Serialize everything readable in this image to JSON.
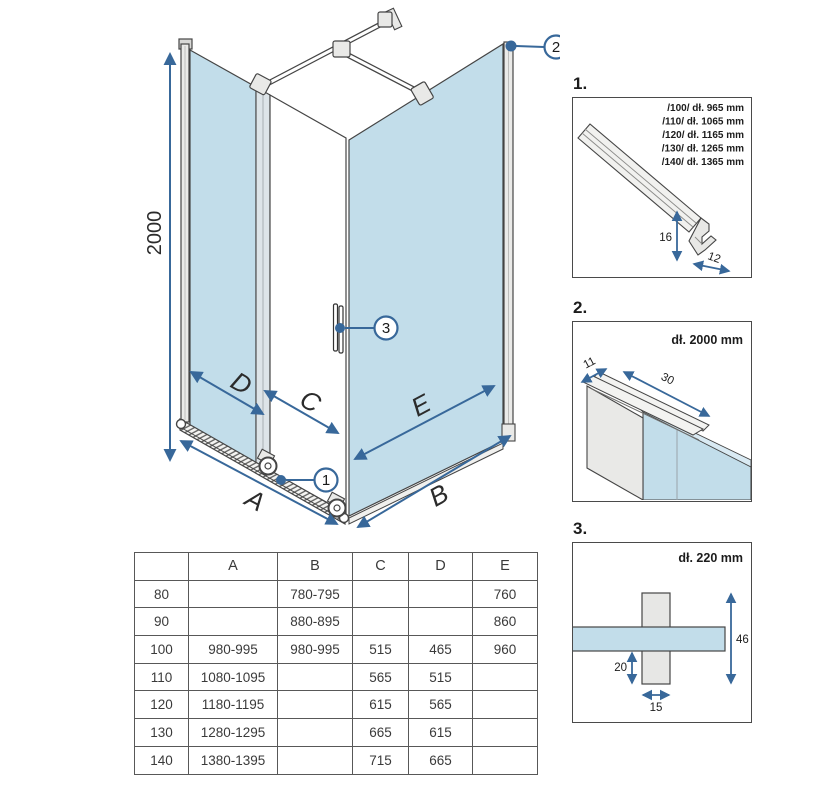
{
  "diagram": {
    "height_dim": "2000",
    "dim_a": "A",
    "dim_b": "B",
    "dim_c": "C",
    "dim_d": "D",
    "dim_e": "E",
    "callout_1": "1",
    "callout_2": "2",
    "callout_3": "3"
  },
  "details": {
    "d1": {
      "label": "1.",
      "size_lines": [
        "/100/ dł. 965 mm",
        "/110/ dł. 1065 mm",
        "/120/ dł. 1165 mm",
        "/130/ dł. 1265 mm",
        "/140/ dł. 1365 mm"
      ],
      "dim_height": "16",
      "dim_depth": "12"
    },
    "d2": {
      "label": "2.",
      "length": "dł. 2000 mm",
      "dim_width": "11",
      "dim_depth": "30"
    },
    "d3": {
      "label": "3.",
      "length": "dł. 220 mm",
      "dim_total_height": "46",
      "dim_lower_height": "20",
      "dim_width": "15"
    }
  },
  "table": {
    "headers": [
      "",
      "A",
      "B",
      "C",
      "D",
      "E"
    ],
    "rows": [
      [
        "80",
        "",
        "780-795",
        "",
        "",
        "760"
      ],
      [
        "90",
        "",
        "880-895",
        "",
        "",
        "860"
      ],
      [
        "100",
        "980-995",
        "980-995",
        "515",
        "465",
        "960"
      ],
      [
        "110",
        "1080-1095",
        "",
        "565",
        "515",
        ""
      ],
      [
        "120",
        "1180-1195",
        "",
        "615",
        "565",
        ""
      ],
      [
        "130",
        "1280-1295",
        "",
        "665",
        "615",
        ""
      ],
      [
        "140",
        "1380-1395",
        "",
        "715",
        "665",
        ""
      ]
    ]
  },
  "colors": {
    "glass": "#c2ddea",
    "arrow": "#38689a",
    "outline": "#454545"
  }
}
